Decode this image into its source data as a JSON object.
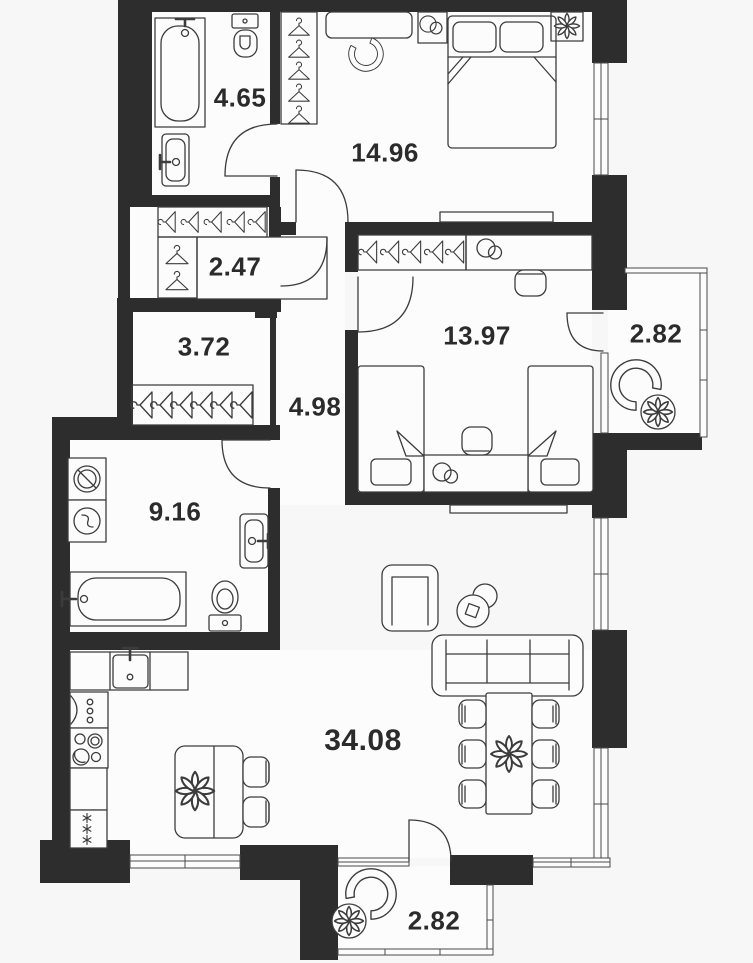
{
  "plan": {
    "type": "apartment-floor-plan",
    "rooms": [
      {
        "name": "bathroom-small",
        "area": "4.65"
      },
      {
        "name": "bedroom",
        "area": "14.96"
      },
      {
        "name": "wardrobe-closet",
        "area": "2.47"
      },
      {
        "name": "hallway",
        "area": "3.72"
      },
      {
        "name": "kids-bedroom",
        "area": "13.97"
      },
      {
        "name": "balcony-right",
        "area": "2.82"
      },
      {
        "name": "corridor",
        "area": "4.98"
      },
      {
        "name": "bathroom-large",
        "area": "9.16"
      },
      {
        "name": "living-kitchen",
        "area": "34.08"
      },
      {
        "name": "balcony-bottom",
        "area": "2.82"
      }
    ],
    "colors": {
      "wall": "#2d2d2d",
      "furniture_line": "#3c3c3c",
      "background": "#f7f7f7",
      "floor": "#fcfcfc",
      "label": "#2b2b2b"
    }
  }
}
